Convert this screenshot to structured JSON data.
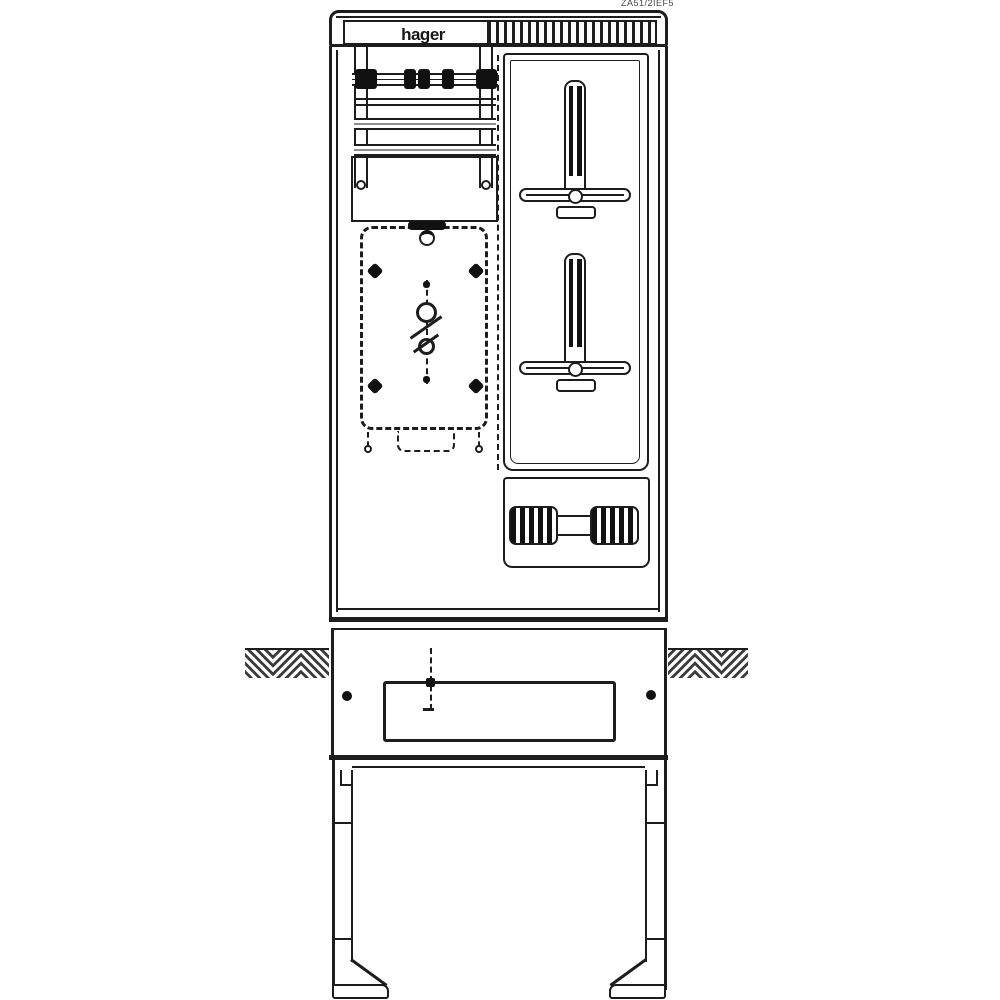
{
  "drawing": {
    "title": "meter-cabinet-technical-drawing",
    "brand_logo": "hager",
    "part_number": "ZA51/2IEF5",
    "colors": {
      "line": "#1d1d1d",
      "background": "#ffffff"
    },
    "components": [
      "top-cap-with-vent-slats",
      "busbar-with-clamps",
      "din-rails",
      "meter-mounting-plate-dashed",
      "meter-fixing-screw-symbol",
      "cable-clamp-bolt-upper",
      "cable-clamp-bolt-lower",
      "connector-turnbuckle",
      "ground-level-hatching",
      "base-cable-entry-opening",
      "mounting-legs"
    ]
  }
}
